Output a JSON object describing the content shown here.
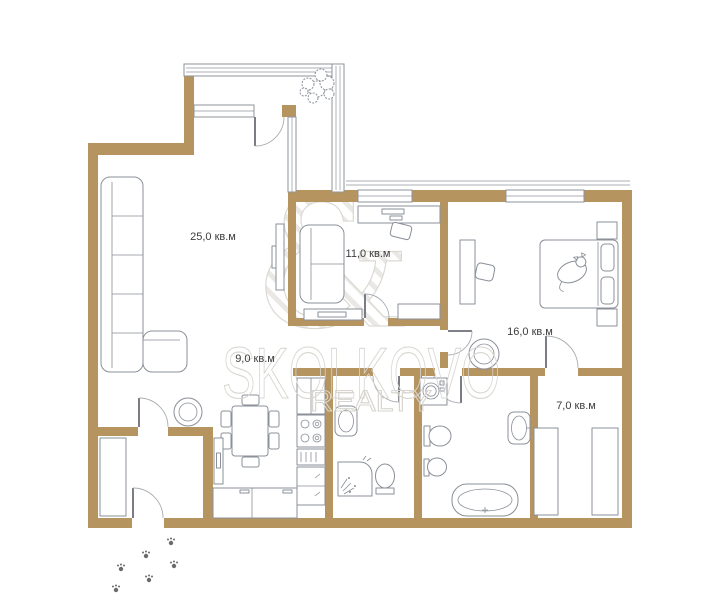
{
  "plan": {
    "type": "apartment-floor-plan",
    "rooms": [
      {
        "id": "living-room",
        "area_label": "25,0 кв.м"
      },
      {
        "id": "office-lounge",
        "area_label": "11,0 кв.м"
      },
      {
        "id": "bedroom",
        "area_label": "16,0 кв.м"
      },
      {
        "id": "kitchen",
        "area_label": "9,0 кв.м"
      },
      {
        "id": "dressing-room",
        "area_label": "7,0 кв.м"
      }
    ],
    "watermark": {
      "brand": "SKOLKOVO",
      "division": "REALTY",
      "logo_glyph": "&"
    },
    "colors": {
      "wall": "#b5945f",
      "furniture_outline": "#8a8f98",
      "label_text": "#3c3c3c",
      "watermark_outline": "#d8d5cf",
      "background": "#ffffff"
    },
    "icons": {
      "plant": "plant-icon",
      "cat": "cat-icon",
      "paw_prints": "paw-prints-icon"
    }
  }
}
